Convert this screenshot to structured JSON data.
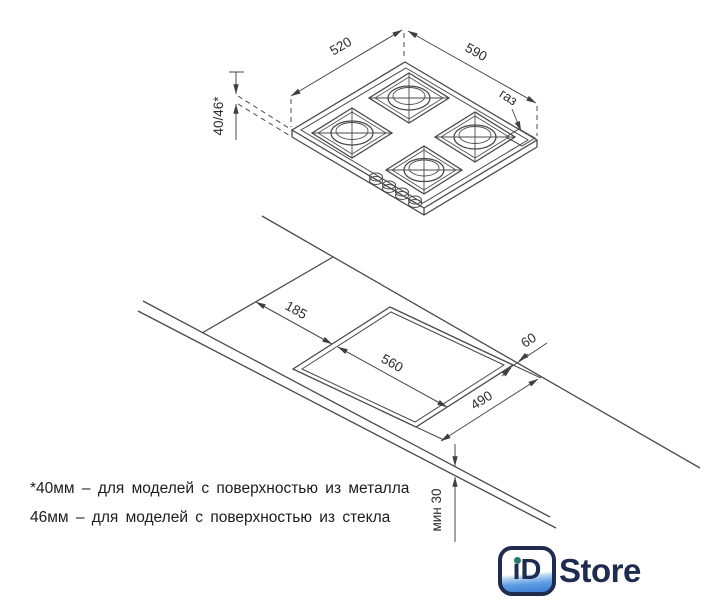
{
  "hob_view": {
    "width_label": "520",
    "depth_label": "590",
    "height_label": "40/46*",
    "gas_label": "газ"
  },
  "cutout_view": {
    "side_offset_label": "185",
    "cutout_length_label": "560",
    "back_gap_label": "60",
    "cutout_width_label": "490",
    "min_clearance_label": "мин 30"
  },
  "footnote": {
    "line1": "*40мм – для моделей с поверхностью из металла",
    "line2": "46мм – для моделей с поверхностью из стекла"
  },
  "logo": {
    "badge_text": "iD",
    "wordmark": "Store"
  },
  "colors": {
    "line": "#4a4a4a",
    "text": "#2e2e2e",
    "logo_navy": "#1f2c4e",
    "logo_blue": "#4a8fd9",
    "logo_teal_dot": "#2a7a6b"
  }
}
